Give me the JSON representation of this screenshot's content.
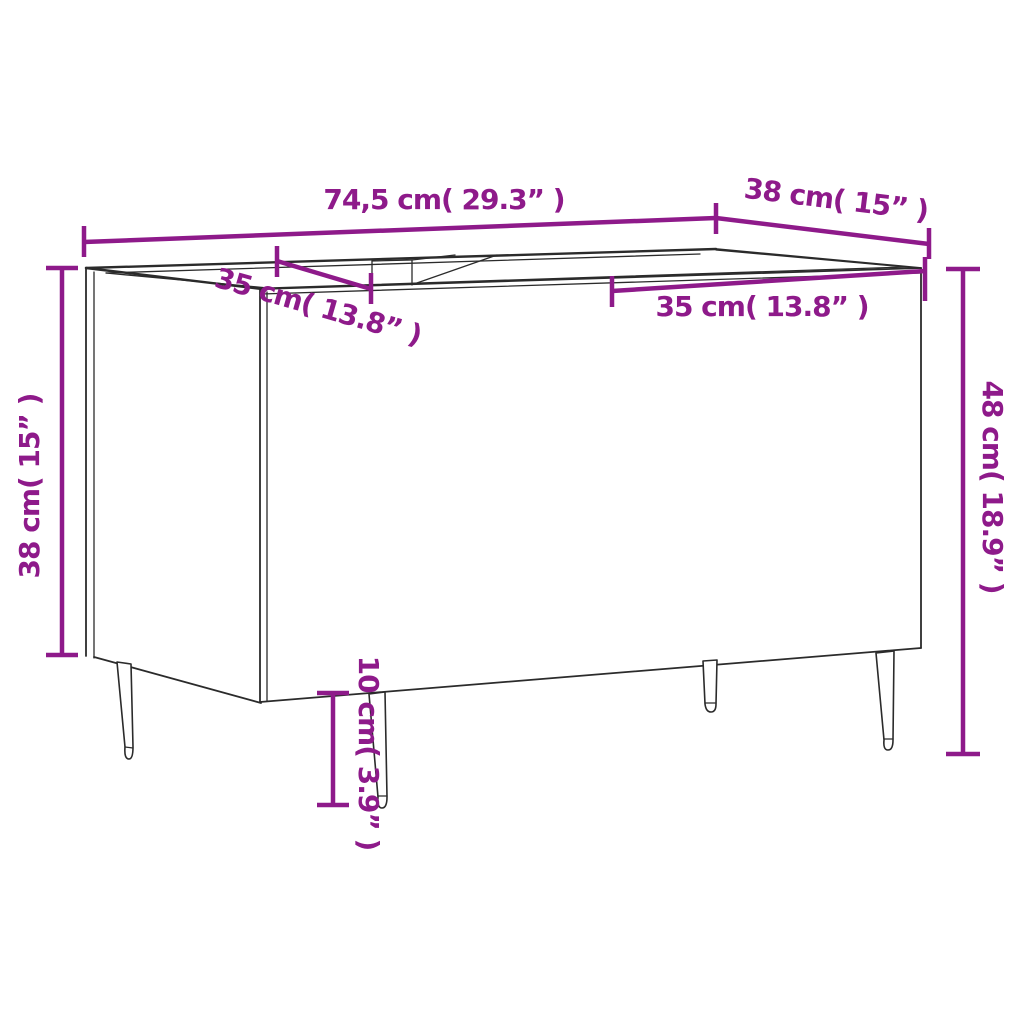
{
  "figure": {
    "title": "record-cabinet-dimension-diagram",
    "accent_color": "#8E1A8A",
    "line_color": "#2b2b2b",
    "background_color": "#ffffff"
  },
  "dimensions": {
    "width": "74,5 cm( 29.3” )",
    "depth": "38 cm( 15” )",
    "compartment_left": "35 cm( 13.8” )",
    "compartment_right": "35 cm( 13.8” )",
    "height_left": "38 cm( 15” )",
    "height_right": "48 cm( 18.9” )",
    "legs": "10 cm( 3.9” )"
  }
}
